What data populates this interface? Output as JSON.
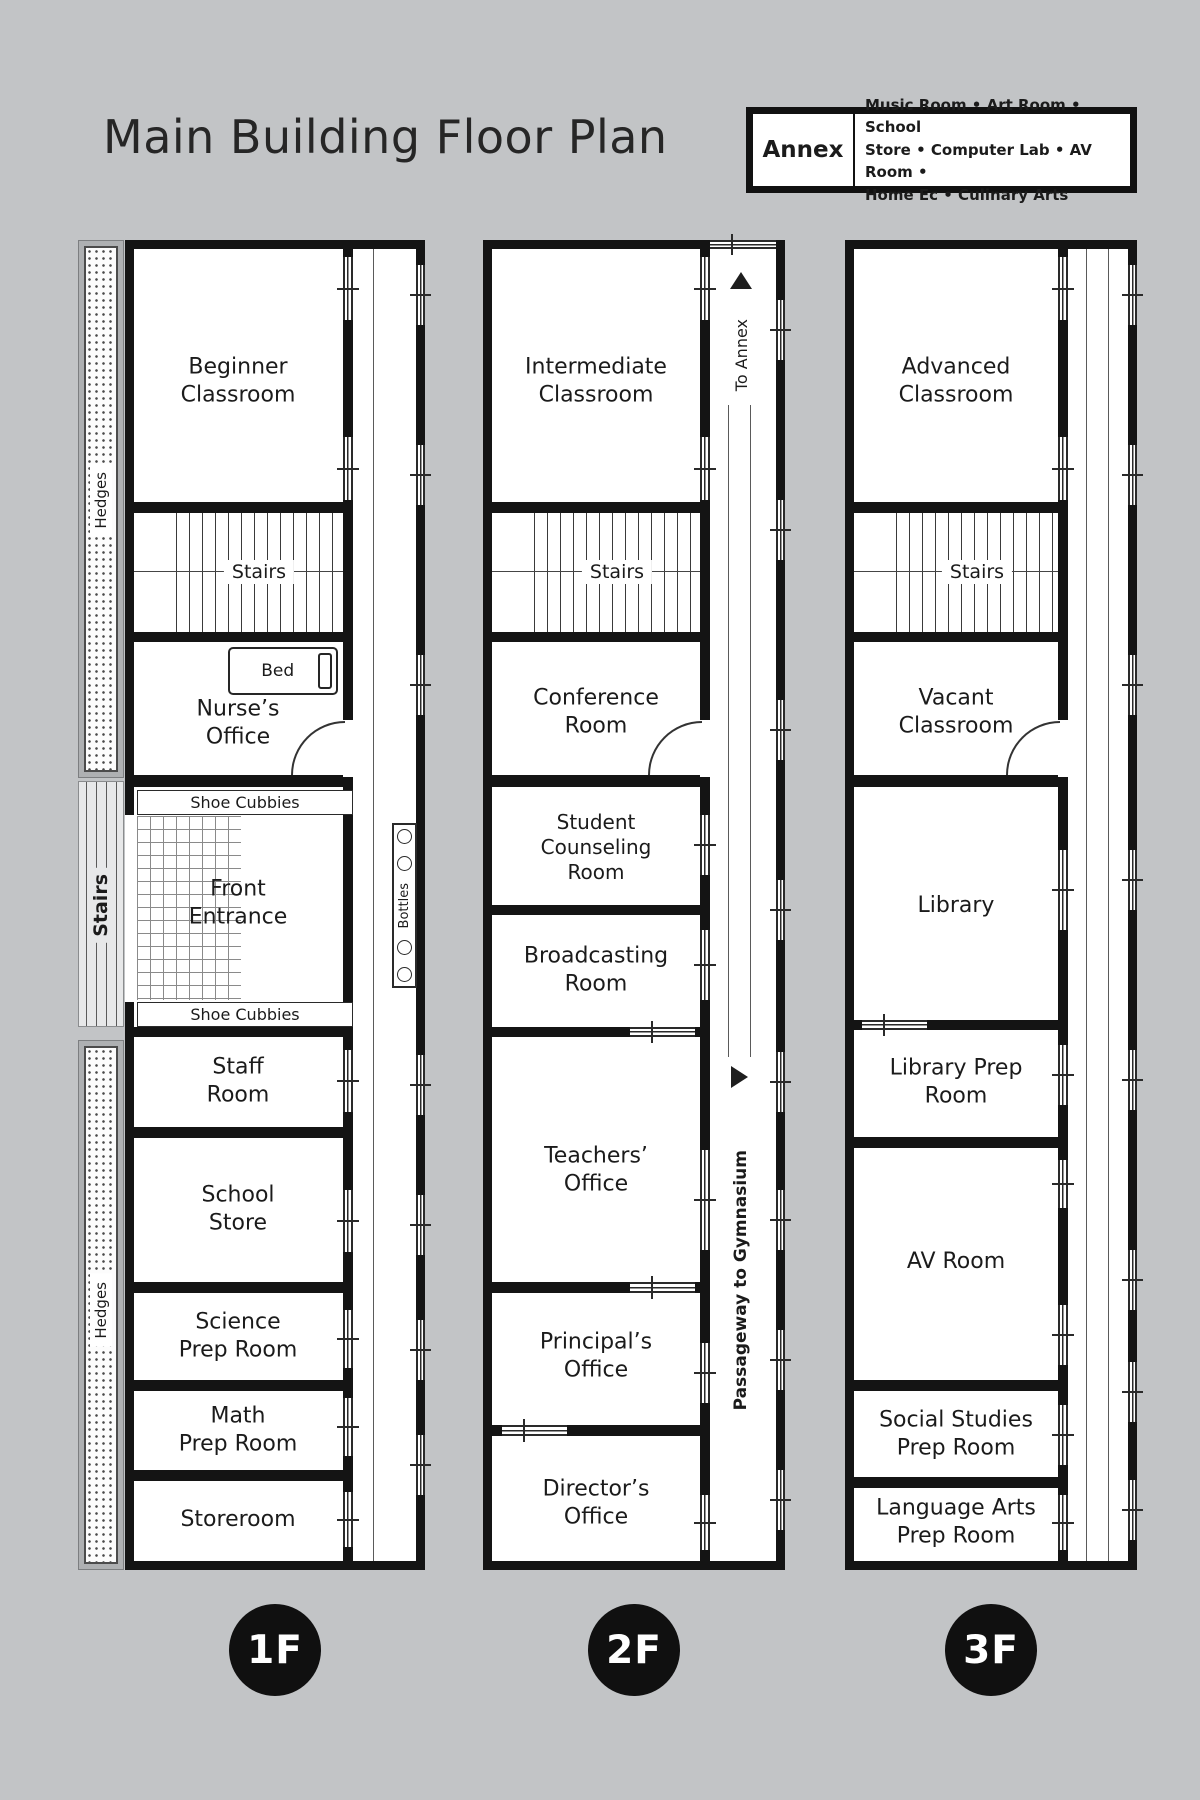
{
  "title": "Main Building Floor Plan",
  "legend": {
    "label": "Annex",
    "lines": [
      "Music Room • Art Room • School",
      "Store • Computer Lab • AV Room •",
      "Home Ec • Culinary Arts"
    ]
  },
  "colors": {
    "background": "#c2c4c6",
    "wall": "#141414",
    "paper": "#ffffff"
  },
  "floors": [
    {
      "badge": "1F",
      "rooms": [
        {
          "name": "Beginner\nClassroom"
        },
        {
          "name": "Stairs"
        },
        {
          "name": "Nurse’s\nOffice"
        },
        {
          "name": "Staff\nRoom"
        },
        {
          "name": "School\nStore"
        },
        {
          "name": "Science\nPrep Room"
        },
        {
          "name": "Math\nPrep Room"
        },
        {
          "name": "Storeroom"
        }
      ],
      "labels": {
        "bed": "Bed",
        "shoe_cubbies_top": "Shoe Cubbies",
        "front_entrance": "Front\nEntrance",
        "shoe_cubbies_bottom": "Shoe Cubbies",
        "bottles": "Bottles",
        "hedges_top": "Hedges",
        "exterior_stairs": "Stairs",
        "hedges_bottom": "Hedges"
      }
    },
    {
      "badge": "2F",
      "rooms": [
        {
          "name": "Intermediate\nClassroom"
        },
        {
          "name": "Stairs"
        },
        {
          "name": "Conference\nRoom"
        },
        {
          "name": "Student\nCounseling\nRoom"
        },
        {
          "name": "Broadcasting\nRoom"
        },
        {
          "name": "Teachers’\nOffice"
        },
        {
          "name": "Principal’s\nOffice"
        },
        {
          "name": "Director’s\nOffice"
        }
      ],
      "labels": {
        "to_annex": "To Annex",
        "passageway": "Passageway to Gymnasium"
      }
    },
    {
      "badge": "3F",
      "rooms": [
        {
          "name": "Advanced\nClassroom"
        },
        {
          "name": "Stairs"
        },
        {
          "name": "Vacant\nClassroom"
        },
        {
          "name": "Library"
        },
        {
          "name": "Library Prep\nRoom"
        },
        {
          "name": "AV Room"
        },
        {
          "name": "Social Studies\nPrep Room"
        },
        {
          "name": "Language Arts\nPrep Room"
        }
      ]
    }
  ]
}
